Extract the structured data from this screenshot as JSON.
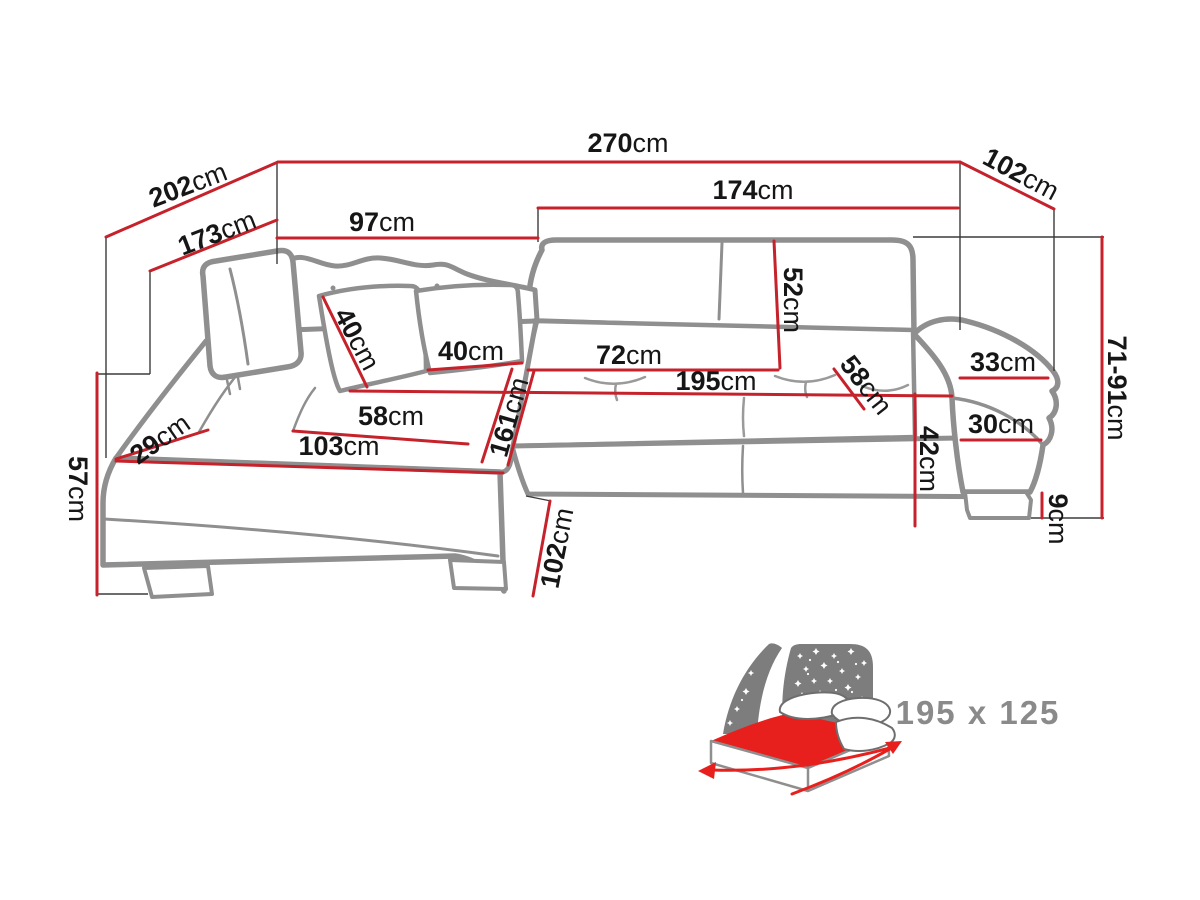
{
  "diagram": {
    "kind": "corner-sofa-technical-dimension-drawing",
    "colors": {
      "background": "#ffffff",
      "sofa_outline": "#8f8f8f",
      "dimension_line": "#c5222b",
      "leader_line": "#3b3b3b",
      "label_text": "#161616",
      "bed_icon_gray": "#7d7d7d",
      "bed_icon_red": "#e8201d",
      "bed_label_gray": "#8a8a8a"
    },
    "dims": [
      {
        "id": "total-width-top",
        "value": "270",
        "unit": "cm"
      },
      {
        "id": "chaise-outer-diagonal",
        "value": "202",
        "unit": "cm"
      },
      {
        "id": "chaise-inner-diagonal",
        "value": "173",
        "unit": "cm"
      },
      {
        "id": "back-left-section",
        "value": "97",
        "unit": "cm"
      },
      {
        "id": "back-right-section",
        "value": "174",
        "unit": "cm"
      },
      {
        "id": "side-depth-right",
        "value": "102",
        "unit": "cm"
      },
      {
        "id": "height-range",
        "value": "71-91",
        "unit": "cm"
      },
      {
        "id": "backrest-height",
        "value": "52",
        "unit": "cm"
      },
      {
        "id": "pillow-left-size",
        "value": "40",
        "unit": "cm"
      },
      {
        "id": "pillow-right-size",
        "value": "40",
        "unit": "cm"
      },
      {
        "id": "seat-depth",
        "value": "72",
        "unit": "cm"
      },
      {
        "id": "sleeping-length",
        "value": "195",
        "unit": "cm"
      },
      {
        "id": "seat-depth-diagonal",
        "value": "58",
        "unit": "cm"
      },
      {
        "id": "armrest-top-width",
        "value": "33",
        "unit": "cm"
      },
      {
        "id": "armrest-front-width",
        "value": "30",
        "unit": "cm"
      },
      {
        "id": "seat-height",
        "value": "42",
        "unit": "cm"
      },
      {
        "id": "leg-height",
        "value": "9",
        "unit": "cm"
      },
      {
        "id": "chaise-seat-width",
        "value": "58",
        "unit": "cm"
      },
      {
        "id": "chaise-seat-length",
        "value": "103",
        "unit": "cm"
      },
      {
        "id": "side-ledge-width",
        "value": "29",
        "unit": "cm"
      },
      {
        "id": "chaise-total-length",
        "value": "161",
        "unit": "cm"
      },
      {
        "id": "chaise-front-depth",
        "value": "102",
        "unit": "cm"
      },
      {
        "id": "chaise-front-height",
        "value": "57",
        "unit": "cm"
      }
    ],
    "bed": {
      "size": "195 x 125"
    }
  }
}
